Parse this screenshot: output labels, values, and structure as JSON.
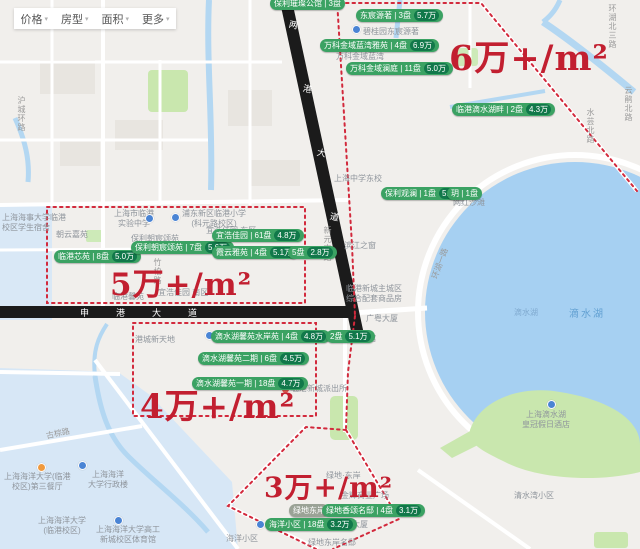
{
  "filter_bar": {
    "items": [
      {
        "label": "价格"
      },
      {
        "label": "房型"
      },
      {
        "label": "面积"
      },
      {
        "label": "更多"
      }
    ],
    "caret": "▾"
  },
  "price_zones": [
    {
      "label": "6万+/m²"
    },
    {
      "label": "5万+/m²"
    },
    {
      "label": "4万+/m²"
    },
    {
      "label": "3万+/m²"
    }
  ],
  "zone_border_color": "#d2293c",
  "zone_text_color": "#c21f30",
  "listing_pill_color": "#3ba263",
  "listing_badge_color": "#11784a",
  "listings": [
    {
      "label": "保利璀璨公馆 | 3盘"
    },
    {
      "label": "东宸源著 | 3盘",
      "price": "5.7万"
    },
    {
      "label": "万科金域蓝湾雅苑 | 4盘",
      "price": "6.9万"
    },
    {
      "label": "万科金域澜庭 | 11盘",
      "price": "5.0万"
    },
    {
      "label": "临港滴水湖畔 | 2盘",
      "price": "4.3万"
    },
    {
      "label": "保利观澜 | 1盘",
      "price": "5.2万"
    },
    {
      "label": "玥 | 1盘"
    },
    {
      "label": "临港芯苑 | 8盘",
      "price": "5.0万"
    },
    {
      "label": "保利朝宸颂苑 | 7盘",
      "price": "5.6万"
    },
    {
      "label": "宜浩佳园 | 61盘",
      "price": "4.8万"
    },
    {
      "label": "霞云雅苑 | 4盘",
      "price": "5.1万"
    },
    {
      "label": "5盘",
      "price": "2.8万"
    },
    {
      "label": "滴水湖馨苑水岸苑 | 4盘",
      "price": "4.8万"
    },
    {
      "label": "2盘",
      "price": "5.1万"
    },
    {
      "label": "滴水湖馨苑二期 | 6盘",
      "price": "4.5万"
    },
    {
      "label": "滴水湖馨苑一期 | 18盘",
      "price": "4.7万"
    },
    {
      "label": "绿地东岸"
    },
    {
      "label": "绿地香颂名邸 | 4盘",
      "price": "3.1万"
    },
    {
      "label": "海洋小区 | 18盘",
      "price": "3.2万"
    }
  ],
  "map_texts": [
    {
      "text": "碧桂园东宸源著"
    },
    {
      "text": "万科金域蓝湾"
    },
    {
      "text": "上海中学东校"
    },
    {
      "text": "临港新城主城区\n综合配套商品房"
    },
    {
      "text": "广粤大厦"
    },
    {
      "text": "中国航海博物馆"
    },
    {
      "text": "朝云嘉苑"
    },
    {
      "text": "保利朝宸颂苑"
    },
    {
      "text": "宜浩佳园 东区"
    },
    {
      "text": "宜浩佳园 南区"
    },
    {
      "text": "临港馨苑"
    },
    {
      "text": "上海海事大学临港\n校区学生宿舍"
    },
    {
      "text": "上海市临港\n实验中学"
    },
    {
      "text": "浦东新区临港小学\n(科元路校区)"
    },
    {
      "text": "港城新天地"
    },
    {
      "text": "临港新城派出所"
    },
    {
      "text": "网红沙滩"
    },
    {
      "text": "上海滴水湖\n皇冠假日酒店"
    },
    {
      "text": "上海海洋大学(临港\n校区)第三餐厅"
    },
    {
      "text": "上海海洋\n大学行政楼"
    },
    {
      "text": "上海海洋大学\n(临港校区)"
    },
    {
      "text": "上海海洋大学高工\n新城校区体育馆"
    },
    {
      "text": "海洋小区"
    },
    {
      "text": "绿地东岸名邸"
    },
    {
      "text": "金辉商业广场"
    },
    {
      "text": "金辉大厦"
    },
    {
      "text": "绿地·东岸"
    },
    {
      "text": "清水湾小区"
    },
    {
      "text": "滴水湖"
    },
    {
      "text": "滴水湖"
    },
    {
      "text": "滨江之窗"
    }
  ],
  "road_labels": [
    {
      "name": "竹柏路"
    },
    {
      "name": "新元南路"
    },
    {
      "name": "古棕路"
    },
    {
      "name": "环湖一路"
    },
    {
      "name": "环湖北三路"
    },
    {
      "name": "云鹃北路"
    },
    {
      "name": "水芸北路"
    },
    {
      "name": "沪城环路"
    }
  ],
  "avenues": {
    "shengang": [
      "申",
      "港",
      "大",
      "道"
    ],
    "lianggang": [
      "两",
      "港",
      "大",
      "道"
    ]
  },
  "lake": {
    "fill": "#a6d0f2"
  }
}
